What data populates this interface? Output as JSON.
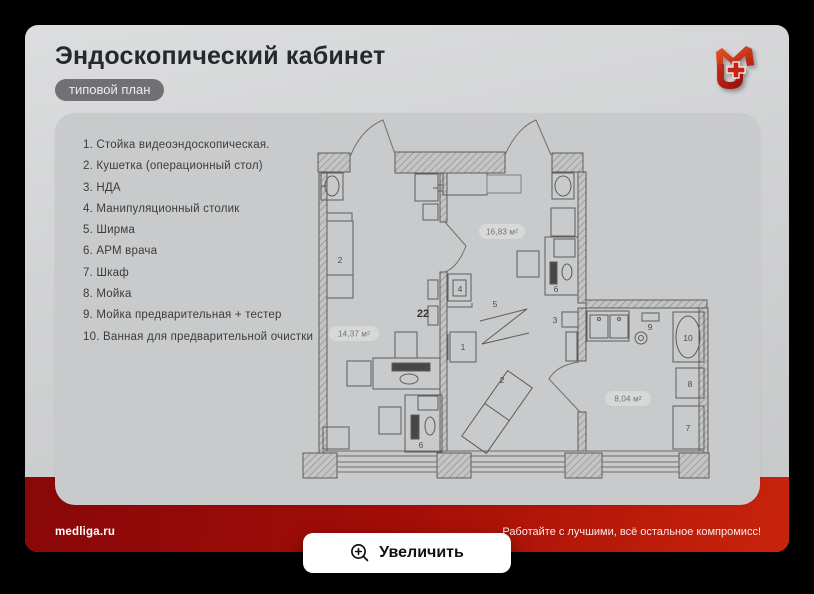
{
  "slide": {
    "title": "Эндоскопический кабинет",
    "badge": "типовой план",
    "footer": {
      "site": "medliga.ru",
      "slogan": "Работайте с лучшими, всё остальное компромисс!"
    },
    "zoom_button_label": "Увеличить"
  },
  "legend": {
    "items": [
      "1. Стойка видеоэндоскопическая.",
      "2. Кушетка (операционный стол)",
      "3. НДА",
      "4. Манипуляционный столик",
      "5. Ширма",
      "6. АРМ врача",
      "7. Шкаф",
      "8. Мойка",
      "9. Мойка предварительная + тестер",
      "10. Ванная для предварительной очистки"
    ]
  },
  "plan": {
    "areas": {
      "left": "14,37 м²",
      "middle": "16,83 м²",
      "right": "8,04 м²"
    },
    "marks": {
      "n1": "1",
      "n2": "2",
      "n3": "3",
      "n4": "4",
      "n5": "5",
      "n6": "6",
      "n7": "7",
      "n8": "8",
      "n9": "9",
      "n10": "10",
      "n22": "22"
    }
  },
  "colors": {
    "accent_red": "#a30d07",
    "slide_bg": "#d0d1d2",
    "card_bg": "#c9cacb",
    "badge_bg": "#68686c"
  }
}
